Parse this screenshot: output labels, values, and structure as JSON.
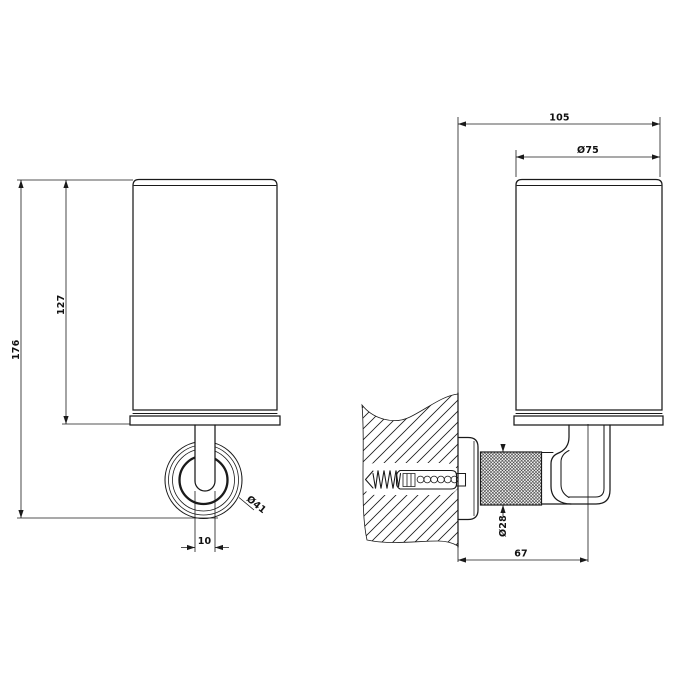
{
  "drawing": {
    "subject": "wall-mounted tumbler holder, two orthographic views",
    "background_color": "#ffffff",
    "line_color": "#1a1a1a",
    "views": {
      "front": {
        "dims": {
          "total_height": "176",
          "cup_height": "127",
          "flange_diameter": "Ø41",
          "stem_width": "10"
        }
      },
      "side": {
        "dims": {
          "total_depth": "105",
          "cup_diameter": "Ø75",
          "knurl_diameter": "Ø28",
          "wall_to_axis": "67"
        }
      }
    }
  }
}
